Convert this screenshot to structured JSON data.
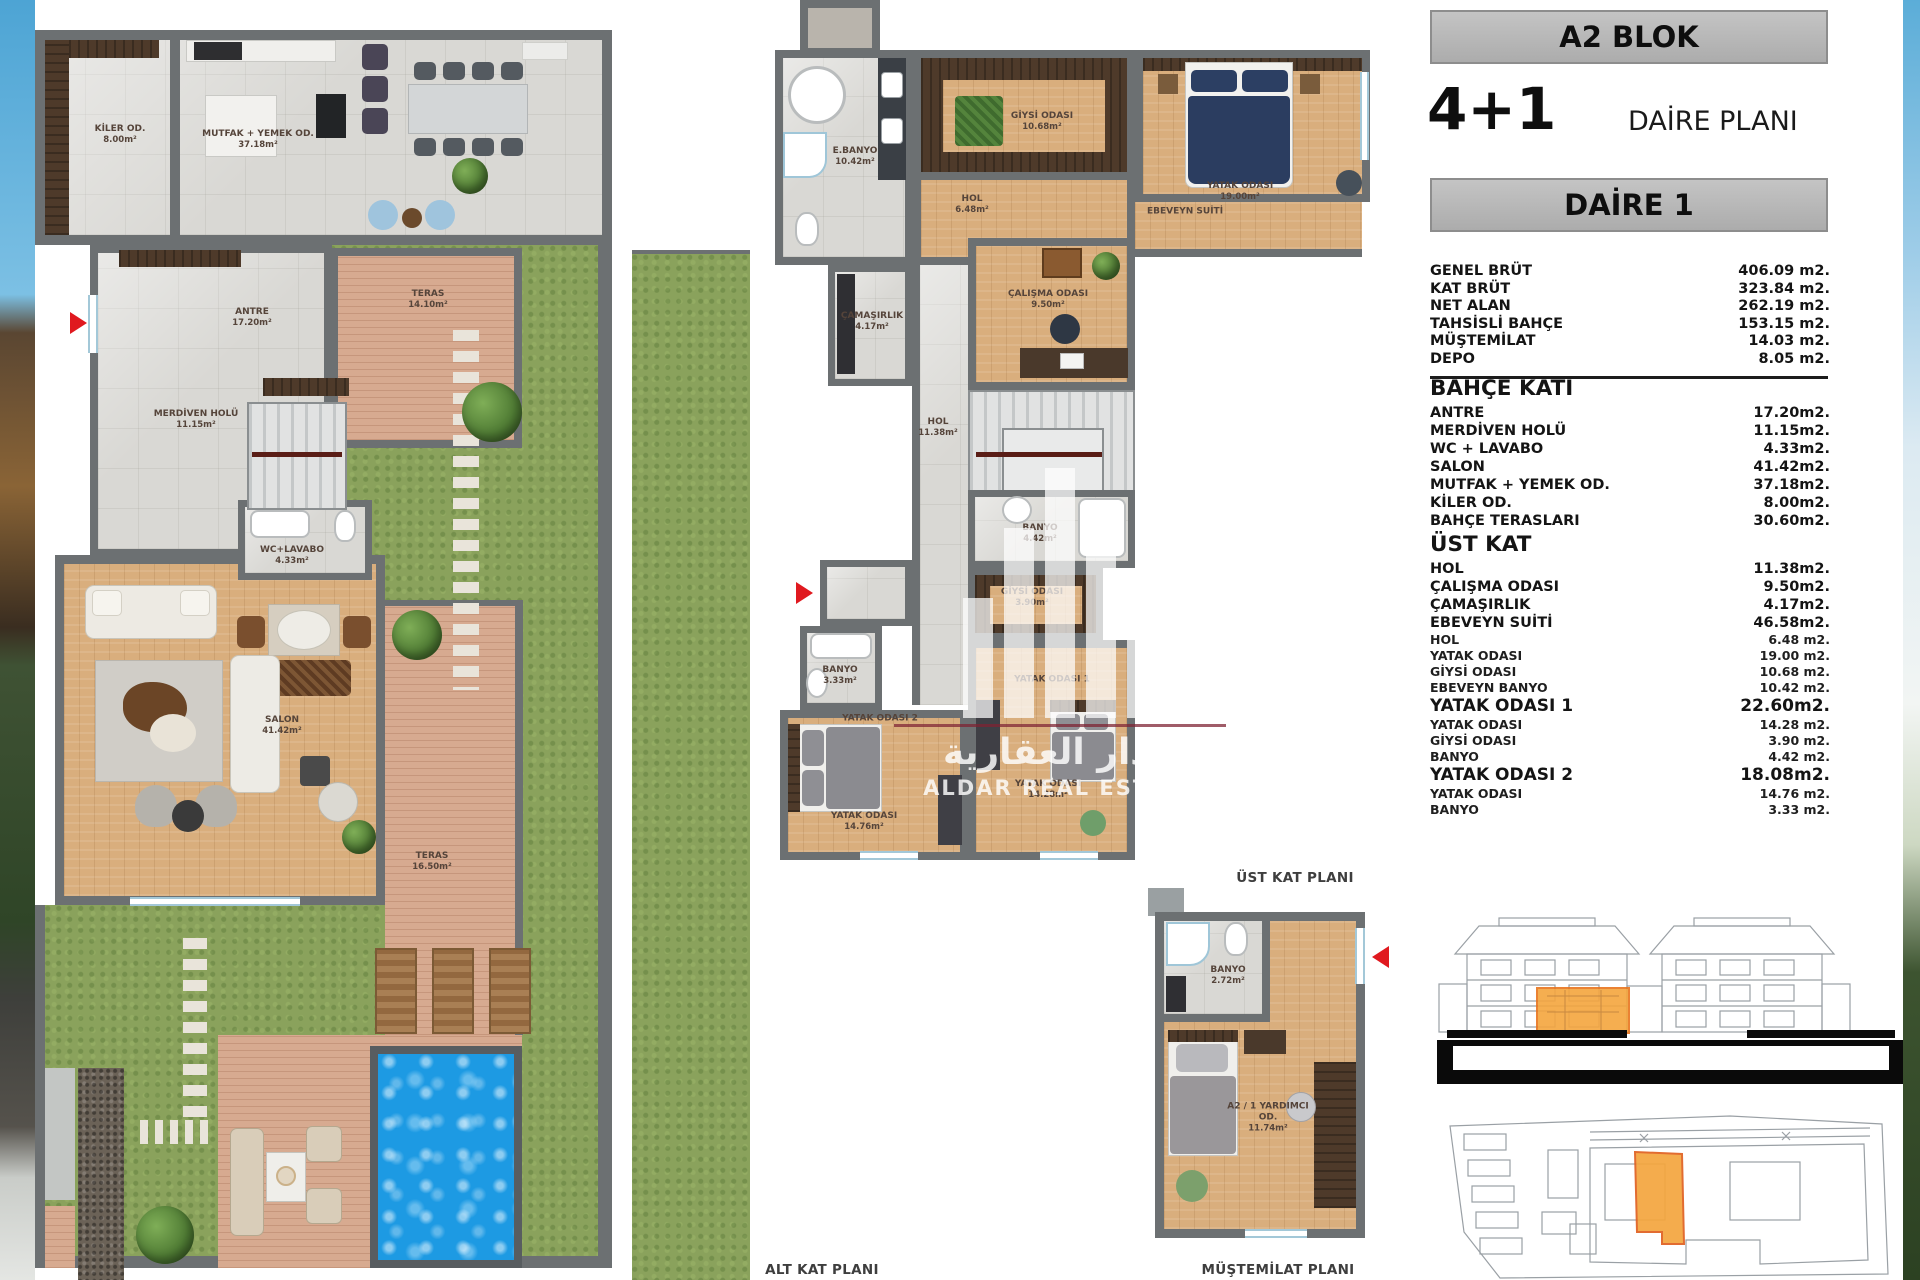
{
  "panel": {
    "block_title": "A2 BLOK",
    "type_label": "4+1",
    "plan_type_label": "DAİRE PLANI",
    "unit_label": "DAİRE 1",
    "summary": [
      {
        "label": "GENEL BRÜT",
        "value": "406.09 m2.",
        "style": "summary"
      },
      {
        "label": "KAT BRÜT",
        "value": "323.84 m2.",
        "style": "summary"
      },
      {
        "label": "NET ALAN",
        "value": "262.19 m2.",
        "style": "summary"
      },
      {
        "label": "TAHSİSLİ BAHÇE",
        "value": "153.15 m2.",
        "style": "summary"
      },
      {
        "label": "MÜŞTEMİLAT",
        "value": "14.03 m2.",
        "style": "summary"
      },
      {
        "label": "DEPO",
        "value": "8.05 m2.",
        "style": "summary"
      }
    ],
    "details": [
      {
        "label": "BAHÇE KATI",
        "value": "",
        "style": "heading"
      },
      {
        "label": "ANTRE",
        "value": "17.20m2.",
        "style": "main"
      },
      {
        "label": "MERDİVEN HOLÜ",
        "value": "11.15m2.",
        "style": "main"
      },
      {
        "label": "WC + LAVABO",
        "value": "4.33m2.",
        "style": "main"
      },
      {
        "label": "SALON",
        "value": "41.42m2.",
        "style": "main"
      },
      {
        "label": "MUTFAK + YEMEK OD.",
        "value": "37.18m2.",
        "style": "main"
      },
      {
        "label": "KİLER OD.",
        "value": "8.00m2.",
        "style": "main"
      },
      {
        "label": "BAHÇE TERASLARI",
        "value": "30.60m2.",
        "style": "main"
      },
      {
        "label": "ÜST KAT",
        "value": "",
        "style": "heading"
      },
      {
        "label": "HOL",
        "value": "11.38m2.",
        "style": "main"
      },
      {
        "label": "ÇALIŞMA ODASI",
        "value": "9.50m2.",
        "style": "main"
      },
      {
        "label": "ÇAMAŞIRLIK",
        "value": "4.17m2.",
        "style": "main"
      },
      {
        "label": "EBEVEYN SUİTİ",
        "value": "46.58m2.",
        "style": "main"
      },
      {
        "label": "HOL",
        "value": "6.48 m2.",
        "style": "sub"
      },
      {
        "label": "YATAK ODASI",
        "value": "19.00 m2.",
        "style": "sub"
      },
      {
        "label": "GİYSİ ODASI",
        "value": "10.68 m2.",
        "style": "sub"
      },
      {
        "label": "EBEVEYN BANYO",
        "value": "10.42 m2.",
        "style": "sub"
      },
      {
        "label": "YATAK ODASI 1",
        "value": "22.60m2.",
        "style": "big"
      },
      {
        "label": "YATAK ODASI",
        "value": "14.28 m2.",
        "style": "sub"
      },
      {
        "label": "GİYSİ ODASI",
        "value": "3.90 m2.",
        "style": "sub"
      },
      {
        "label": "BANYO",
        "value": "4.42 m2.",
        "style": "sub"
      },
      {
        "label": "YATAK ODASI 2",
        "value": "18.08m2.",
        "style": "big"
      },
      {
        "label": "YATAK ODASI",
        "value": "14.76 m2.",
        "style": "sub"
      },
      {
        "label": "BANYO",
        "value": "3.33 m2.",
        "style": "sub"
      }
    ]
  },
  "plans": {
    "alt": {
      "caption": "ALT KAT PLANI",
      "rooms": {
        "kiler": {
          "name": "KİLER OD.",
          "area": "8.00m²"
        },
        "mutfak": {
          "name": "MUTFAK + YEMEK OD.",
          "area": "37.18m²"
        },
        "antre": {
          "name": "ANTRE",
          "area": "17.20m²"
        },
        "teras1": {
          "name": "TERAS",
          "area": "14.10m²"
        },
        "merdiven": {
          "name": "MERDİVEN HOLÜ",
          "area": "11.15m²"
        },
        "wc": {
          "name": "WC+LAVABO",
          "area": "4.33m²"
        },
        "salon": {
          "name": "SALON",
          "area": "41.42m²"
        },
        "teras2": {
          "name": "TERAS",
          "area": "16.50m²"
        }
      }
    },
    "ust": {
      "caption": "ÜST KAT PLANI",
      "rooms": {
        "ebanyo": {
          "name": "E.BANYO",
          "area": "10.42m²"
        },
        "giysi1": {
          "name": "GİYSİ ODASI",
          "area": "10.68m²"
        },
        "yatak_e": {
          "name": "YATAK ODASI",
          "area": "19.00m²"
        },
        "hol1": {
          "name": "HOL",
          "area": "6.48m²"
        },
        "suit": {
          "name": "EBEVEYN SUİTİ",
          "area": ""
        },
        "camasirlik": {
          "name": "ÇAMAŞIRLIK",
          "area": "4.17m²"
        },
        "calisma": {
          "name": "ÇALIŞMA ODASI",
          "area": "9.50m²"
        },
        "hol2": {
          "name": "HOL",
          "area": "11.38m²"
        },
        "banyo1": {
          "name": "BANYO",
          "area": "4.42m²"
        },
        "giysi2": {
          "name": "GİYSİ ODASI",
          "area": "3.90m²"
        },
        "banyo2": {
          "name": "BANYO",
          "area": "3.33m²"
        },
        "yatak2hdr": {
          "name": "YATAK ODASI 2",
          "area": ""
        },
        "yatak2": {
          "name": "YATAK ODASI",
          "area": "14.76m²"
        },
        "yatak1hdr": {
          "name": "YATAK ODASI 1",
          "area": ""
        },
        "yatak1": {
          "name": "YATAK ODASI",
          "area": "14.28m²"
        }
      }
    },
    "mus": {
      "caption": "MÜŞTEMİLAT PLANI",
      "rooms": {
        "banyo": {
          "name": "BANYO",
          "area": "2.72m²"
        },
        "oda": {
          "name": "A2 / 1 YARDIMCI OD.",
          "area": "11.74m²"
        }
      }
    }
  },
  "watermark": {
    "arabic": "الدار العقارية",
    "latin": "ALDAR REAL ESTATE"
  },
  "colors": {
    "wall_gray": "#6C7072",
    "accent_orange": "#F4A63E",
    "arrow_red": "#E0191F",
    "water_blue": "#1D9AE3",
    "grass_green": "#8AA25C"
  }
}
